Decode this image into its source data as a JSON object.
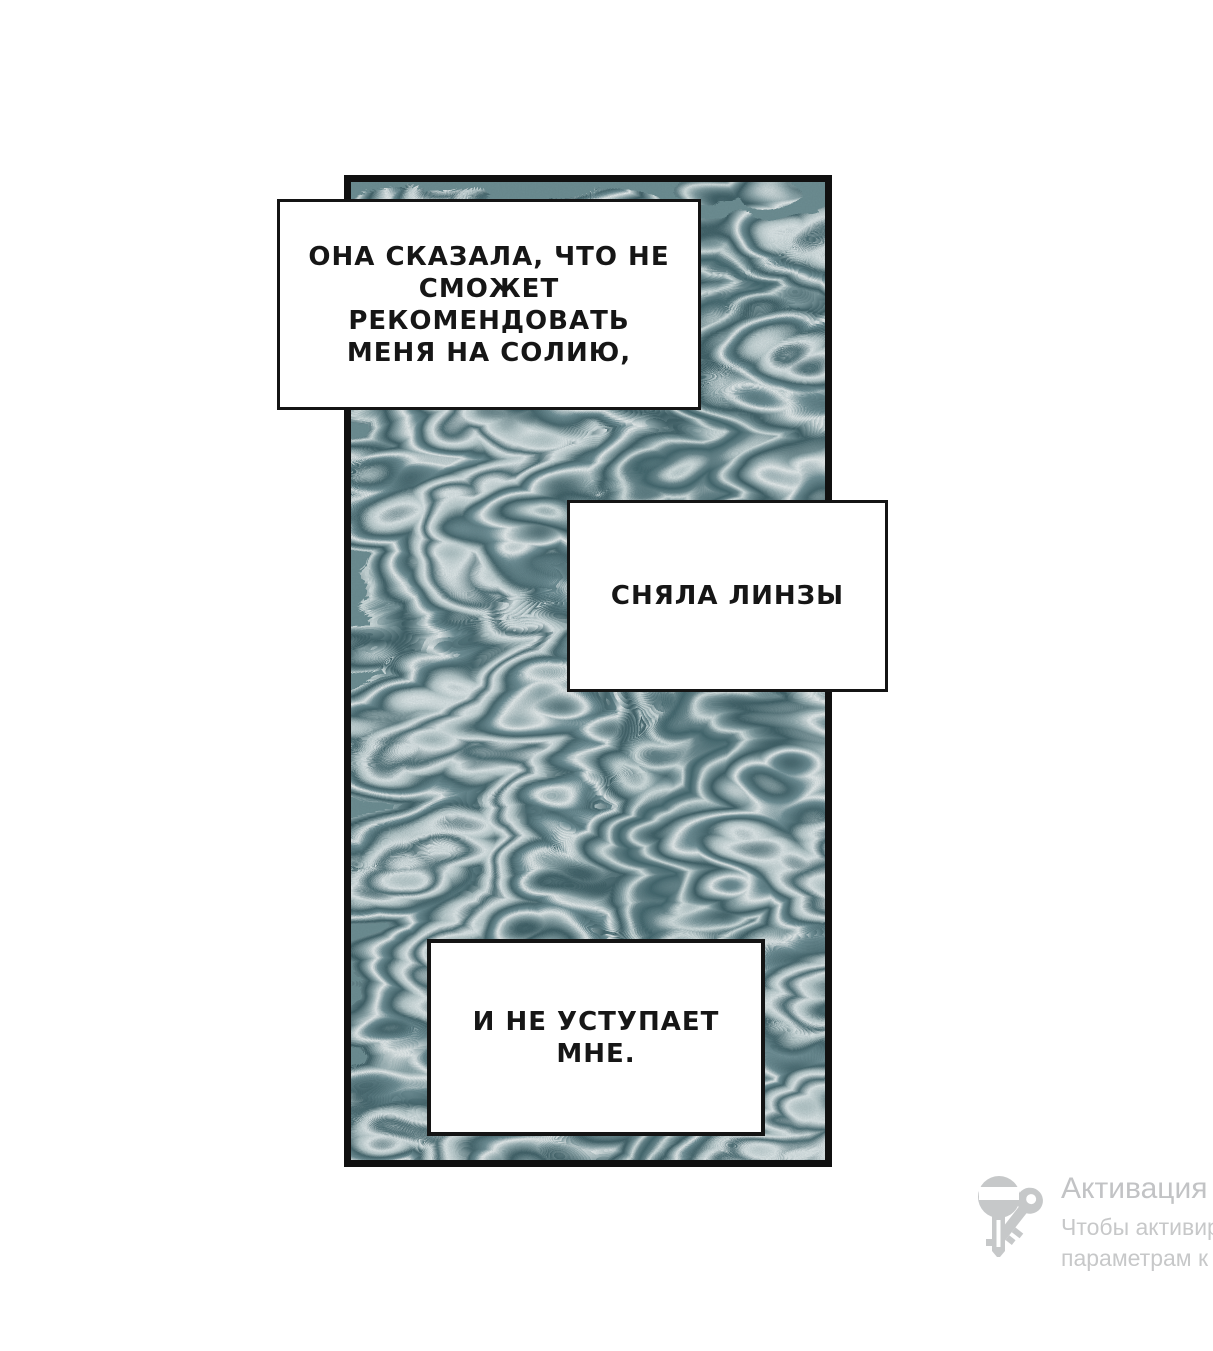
{
  "page": {
    "background": "#ffffff"
  },
  "comic": {
    "panel": {
      "border_color": "#101010",
      "art": "teal-marbled-swirl-texture",
      "marble_palette": {
        "dark": "#3c6067",
        "mid": "#6d8f94",
        "light": "#dde8e8",
        "highlight": "#f0f5f5"
      }
    },
    "boxes": [
      {
        "lines": [
          "ОНА СКАЗАЛА, ЧТО НЕ",
          "СМОЖЕТ РЕКОМЕНДОВАТЬ",
          "МЕНЯ НА СОЛИЮ,"
        ]
      },
      {
        "lines": [
          "СНЯЛА ЛИНЗЫ"
        ]
      },
      {
        "lines": [
          "И НЕ УСТУПАЕТ МНЕ."
        ]
      }
    ]
  },
  "watermark": {
    "title": "Активация",
    "body_line_1": "Чтобы активир",
    "body_line_2": "параметрам к",
    "icon": "keys-icon",
    "icon_color": "#c6c8c9",
    "title_color": "#c2c3c5",
    "body_color": "#c7c8c9"
  }
}
